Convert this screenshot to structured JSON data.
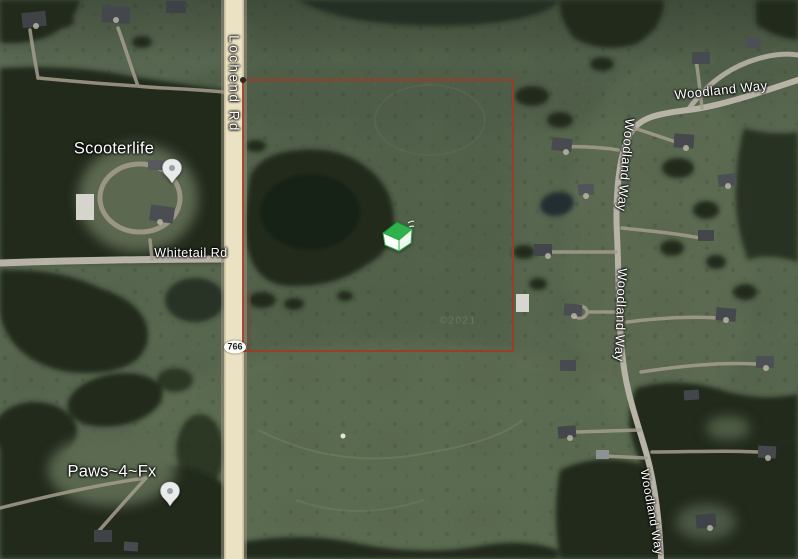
{
  "map": {
    "road_labels": {
      "lochend": "Lochend Rd",
      "whitetail": "Whitetail Rd",
      "woodland": "Woodland Way"
    },
    "route_shield": {
      "number": "766"
    },
    "places": {
      "scooterlife": {
        "name": "Scooterlife"
      },
      "paws": {
        "name": "Paws~4~Fx"
      }
    },
    "property": {
      "boundary_color": "#9e3b24",
      "marker_icon": "green-house-marker"
    },
    "watermark": "©2021",
    "colors": {
      "field": "#57664e",
      "forest": "#212c1d",
      "highway": "#eae2c2",
      "road": "#b7b3a6",
      "label_text": "#ffffff"
    }
  }
}
